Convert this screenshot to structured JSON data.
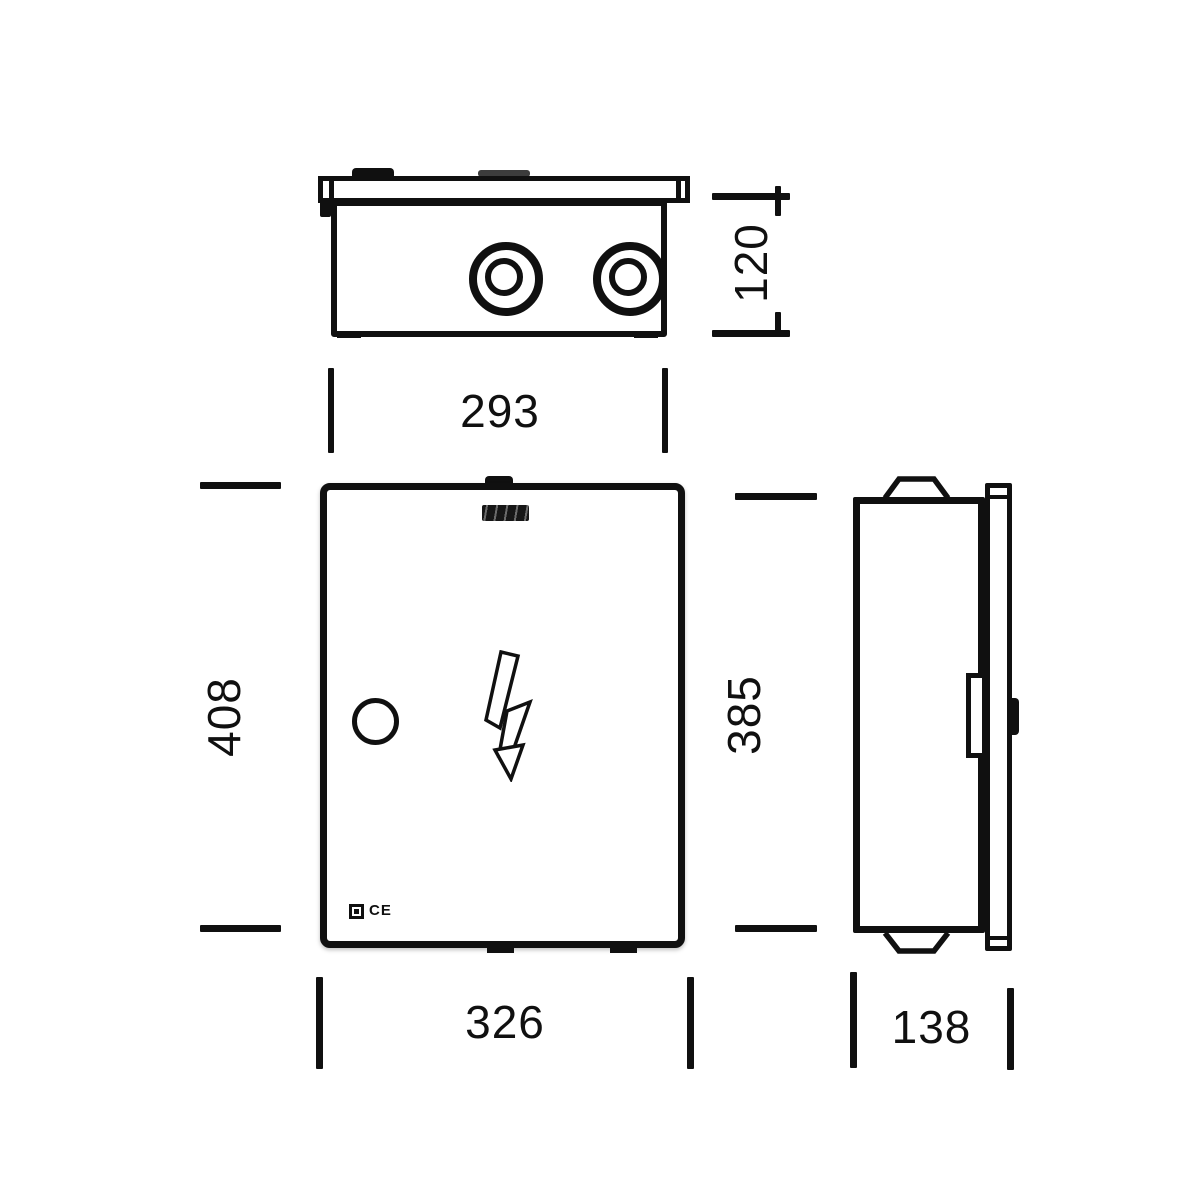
{
  "meta": {
    "ink_color": "#101010",
    "background_color": "#ffffff",
    "drawing_type": "enclosure-dimension-drawing"
  },
  "dimensions": {
    "top_view_depth": "120",
    "top_view_width": "293",
    "front_view_height": "408",
    "front_view_side_height": "385",
    "front_view_width": "326",
    "side_view_depth": "138"
  },
  "front_view": {
    "ce_mark": "CE"
  },
  "icons": {
    "brand_logo": "brand-logo-mark",
    "lightning_bolt": "high-voltage-lightning-arrow",
    "lock": "door-lock-circle",
    "class_ii": "class-ii-double-square",
    "cable_gland": "cable-gland-knockout"
  }
}
